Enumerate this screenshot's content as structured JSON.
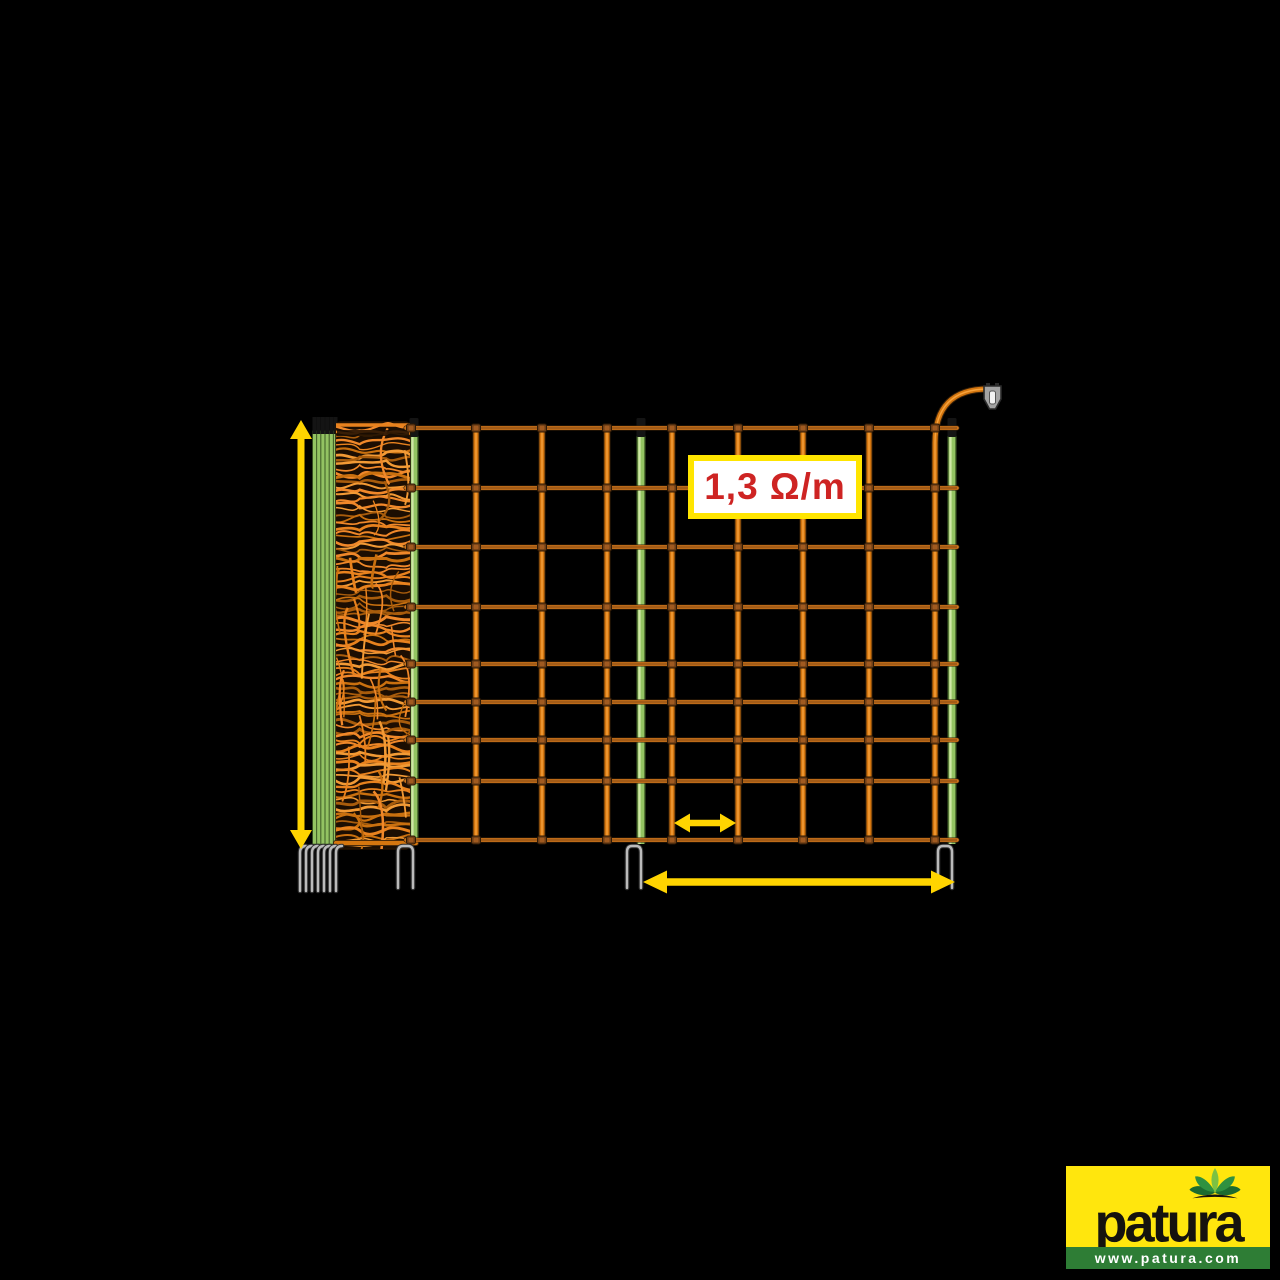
{
  "page": {
    "bg": "#000000",
    "width": 1280,
    "height": 1280
  },
  "resistance_label": {
    "text": "1,3 Ω/m",
    "text_color": "#ce2423",
    "bg": "#ffffff",
    "border_color": "#ffe500"
  },
  "logo": {
    "brand": "patura",
    "url": "www.patura.com",
    "bg": "#ffe60d",
    "strip_bg": "#2e7d35",
    "brand_color": "#15130e",
    "url_color": "#ffffff"
  },
  "figure": {
    "description": "Electric fence netting: rolled-up net with post bundle on the left, orange mesh with green posts, double-spike feet, yellow dimension arrows and a fence connection clip",
    "colors": {
      "wire_dark": "#3a2209",
      "wire": "#e8821e",
      "wire_core": "#5f3610",
      "string": "#d4760f",
      "string_hi": "#f6a23c",
      "knot": "#6f3f16",
      "knot_hi": "#a05a20",
      "knot_edge": "#2e1a06",
      "post_dark": "#44632a",
      "post": "#93c362",
      "post_hi": "#cfe7a6",
      "post_tip": "#141414",
      "spike_dark": "#2f2f2f",
      "spike": "#bbbbbb",
      "arrow": "#ffd400",
      "clip_fill": "#a3a3a3",
      "clip_edge": "#2b2b2b",
      "clip_slot": "#f2f2f2",
      "roll_bg": "#1c0e02",
      "roll_strands": [
        "#e8821e",
        "#f29a35",
        "#c9700f",
        "#a85c0c",
        "#f0882a"
      ]
    },
    "grid": {
      "x_start": 406,
      "x_end": 957,
      "wire_ys": [
        428,
        488,
        547,
        607,
        664,
        702,
        740,
        781,
        840
      ],
      "string_xs": [
        476,
        542,
        607,
        672,
        738,
        803,
        869
      ],
      "knot_extra_xs": [
        411,
        935
      ],
      "end_string_x": 935,
      "curve_top_y": 389,
      "curve_end_x": 988
    },
    "posts": {
      "xs": [
        414,
        641,
        952
      ],
      "tip_top": 418,
      "tip_h": 19,
      "bottom": 844,
      "width": 9
    },
    "bundle": {
      "x_start": 314.5,
      "count": 6,
      "spacing": 4.2,
      "top": 417,
      "bottom": 844
    },
    "roll": {
      "x": 336,
      "y": 422,
      "w": 74,
      "h": 427,
      "strand_seed": 7
    },
    "spikes": {
      "pairs": [
        [
          398,
          413
        ],
        [
          627,
          641
        ],
        [
          938,
          952
        ]
      ],
      "bundle_prongs": [
        300,
        306,
        312,
        318,
        324,
        330,
        336
      ],
      "top": 846,
      "bottom_pair": 888,
      "bottom_prong": 891
    },
    "arrows": {
      "height": {
        "x": 301,
        "y1": 420,
        "y2": 849,
        "shaft": 7,
        "head_l": 19,
        "head_w": 22
      },
      "spacing": {
        "x1": 643,
        "x2": 955,
        "y": 882,
        "shaft": 7.5,
        "head_l": 24,
        "head_w": 23
      },
      "mesh": {
        "x1": 674,
        "x2": 736,
        "y": 823,
        "shaft": 6.5,
        "head_l": 16,
        "head_w": 19
      }
    },
    "clip": {
      "x": 984,
      "y": 386,
      "w": 17
    }
  }
}
